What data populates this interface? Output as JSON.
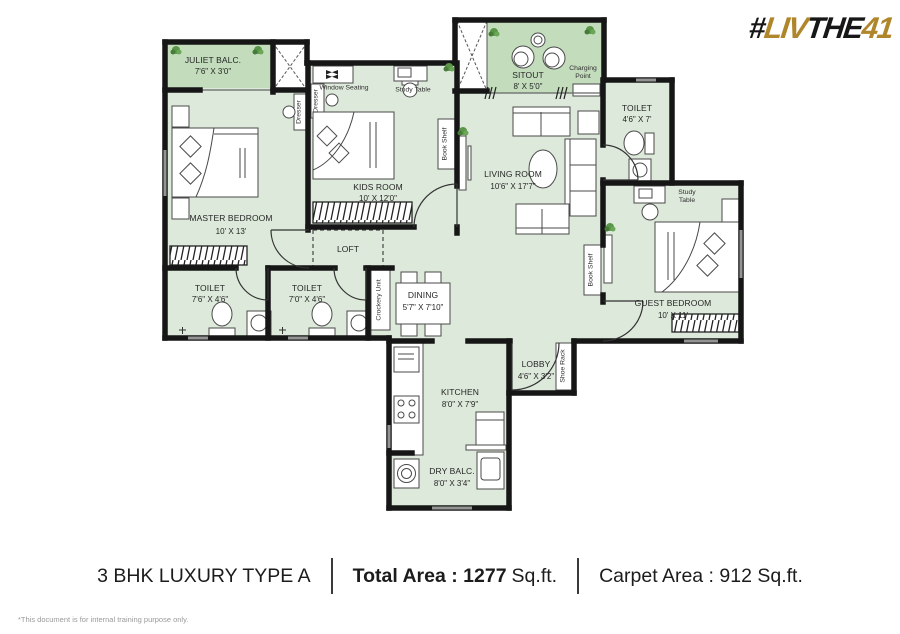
{
  "logo": {
    "hash": "#",
    "liv": "LIV",
    "the": "THE",
    "num": "41"
  },
  "rooms": {
    "juliet_balc": {
      "name": "JULIET BALC.",
      "dims": "7'6\" X 3'0\""
    },
    "master": {
      "name": "MASTER BEDROOM",
      "dims": "10' X 13'"
    },
    "kids": {
      "name": "KIDS ROOM",
      "dims": "10' X 12'0\""
    },
    "living": {
      "name": "LIVING ROOM",
      "dims": "10'6\" X 17'7\""
    },
    "sitout": {
      "name": "SITOUT",
      "dims": "8' X 5'0\""
    },
    "toilet_top": {
      "name": "TOILET",
      "dims": "4'6\" X 7'"
    },
    "guest": {
      "name": "GUEST BEDROOM",
      "dims": "10' X 11'"
    },
    "toilet_left": {
      "name": "TOILET",
      "dims": "7'6\" X 4'6\""
    },
    "toilet_mid": {
      "name": "TOILET",
      "dims": "7'0\" X 4'6\""
    },
    "dining": {
      "name": "DINING",
      "dims": "5'7\" X 7'10\""
    },
    "kitchen": {
      "name": "KITCHEN",
      "dims": "8'0\" X 7'9\""
    },
    "dry_balc": {
      "name": "DRY BALC.",
      "dims": "8'0\" X 3'4\""
    },
    "lobby": {
      "name": "LOBBY",
      "dims": "4'6\" X 3'2\""
    },
    "loft": {
      "name": "LOFT"
    }
  },
  "fixtures": {
    "window_seating": "Window Seating",
    "study_table": "Study Table",
    "dresser": "Dresser",
    "book_shelf": "Book Shelf",
    "crockery_unit": "Crockery Unit",
    "shoe_rack": "Shoe Rack",
    "charging_point": "Charging Point"
  },
  "footer": {
    "title": "3 BHK LUXURY TYPE A",
    "total_bold": "Total Area : 1277",
    "total_unit": "Sq.ft.",
    "carpet": "Carpet Area : 912 Sq.ft."
  },
  "disclaimer": "*This document is for internal training purpose only.",
  "colors": {
    "room_fill": "#dde9da",
    "balcony_fill": "#c2dcbc",
    "wall": "#161616",
    "gold": "#b0862b"
  }
}
